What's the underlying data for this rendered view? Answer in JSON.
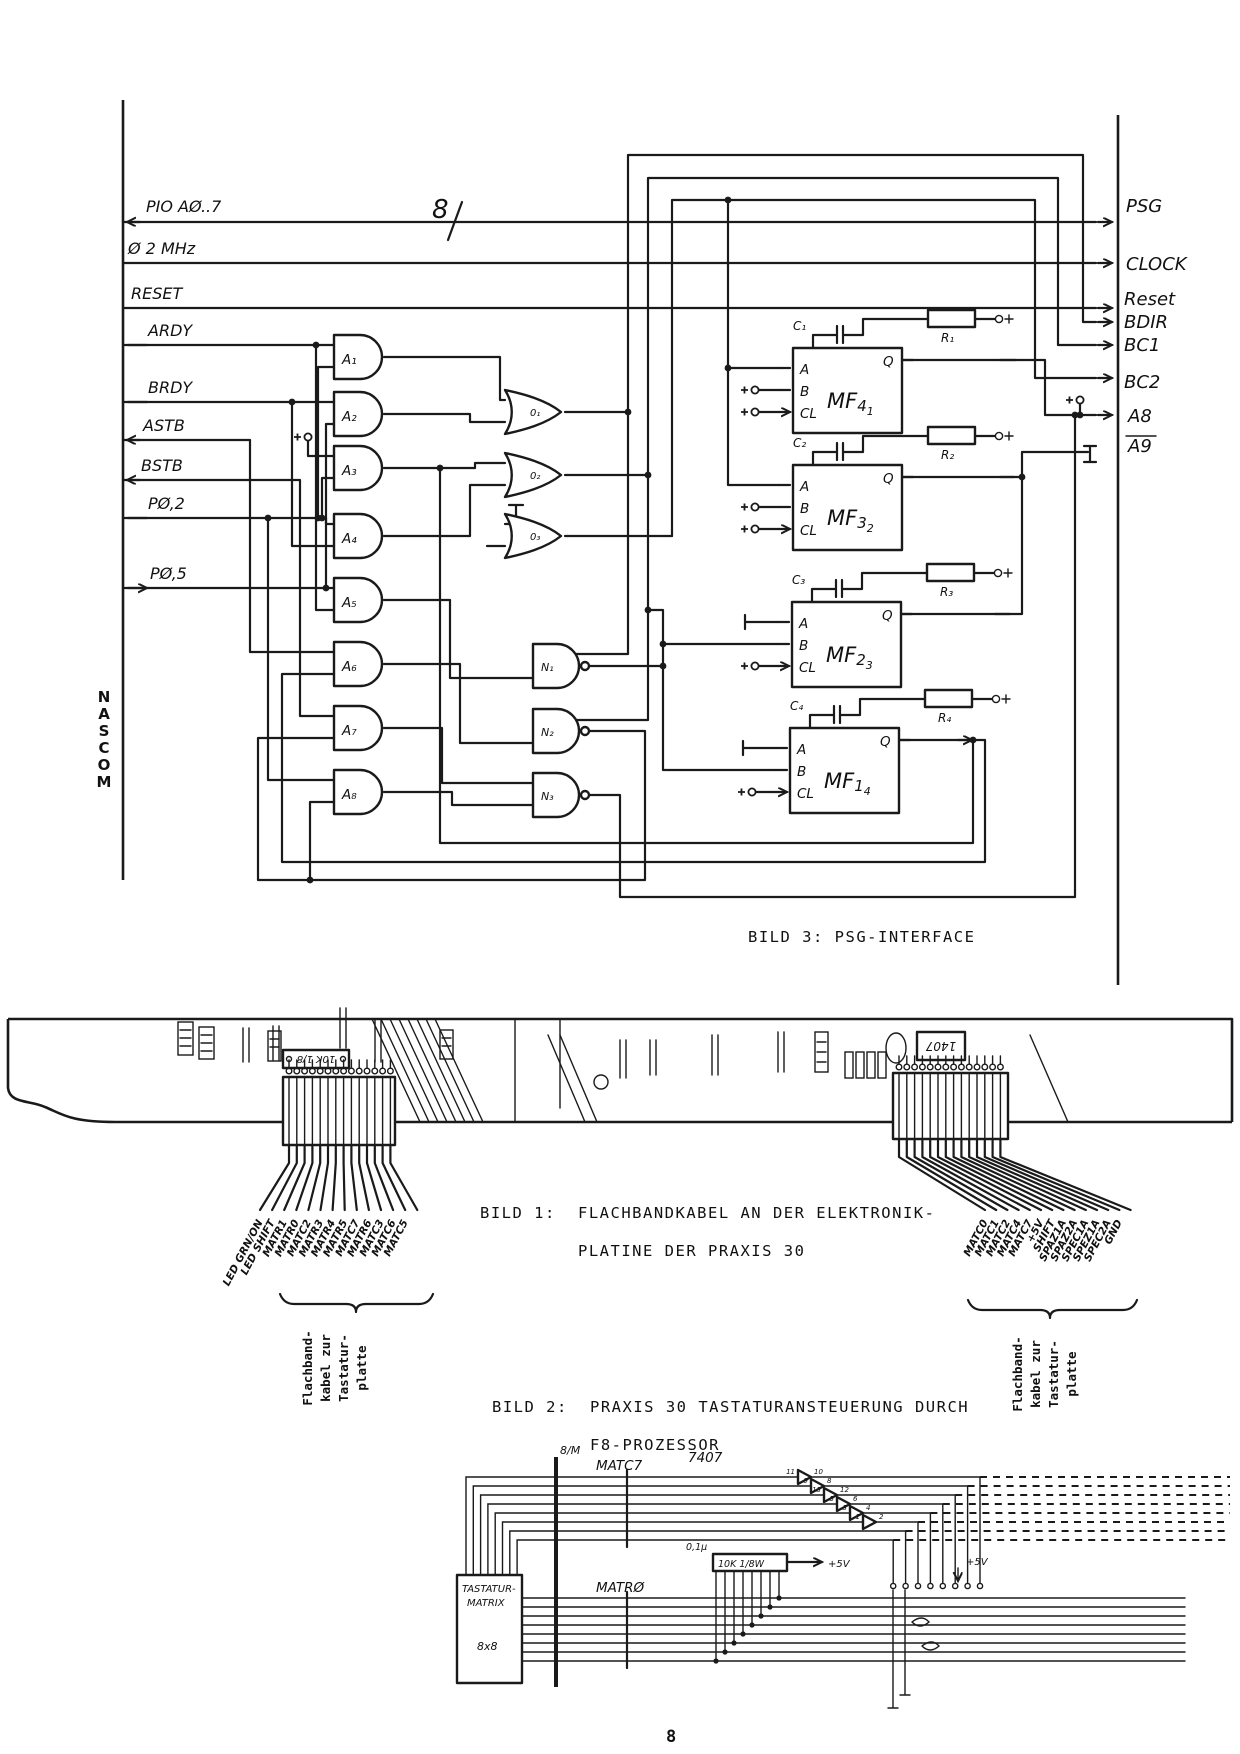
{
  "page": {
    "number": "8",
    "ink": "#1a1a1a",
    "background": "#ffffff"
  },
  "figure3": {
    "caption": "BILD 3:  PSG-INTERFACE",
    "side_label": "NASCOM",
    "bus_width_label": "8",
    "left_signals": [
      "PIO AØ..7",
      "Ø 2 MHz",
      "RESET",
      "ARDY",
      "BRDY",
      "ASTB",
      "BSTB",
      "PØ,2",
      "PØ,5"
    ],
    "right_signals": [
      "PSG",
      "CLOCK",
      "Reset",
      "BDIR",
      "BC1",
      "BC2",
      "A8",
      "A9"
    ],
    "overlined_right_signal": "A9",
    "and_gates": [
      "A₁",
      "A₂",
      "A₃",
      "A₄",
      "A₅",
      "A₆",
      "A₇",
      "A₈"
    ],
    "or_gates": [
      "0₁",
      "0₂",
      "0₃"
    ],
    "nand_gates": [
      "N₁",
      "N₂",
      "N₃"
    ],
    "mf_pins": {
      "a": "A",
      "b": "B",
      "cl": "CL",
      "q": "Q"
    },
    "mf_blocks": [
      {
        "label": "MF",
        "num": "4",
        "idx": "1",
        "cap": "C₁",
        "res": "R₁"
      },
      {
        "label": "MF",
        "num": "3",
        "idx": "2",
        "cap": "C₂",
        "res": "R₂"
      },
      {
        "label": "MF",
        "num": "2",
        "idx": "3",
        "cap": "C₃",
        "res": "R₃"
      },
      {
        "label": "MF",
        "num": "1",
        "idx": "4",
        "cap": "C₄",
        "res": "R₄"
      }
    ]
  },
  "figure1": {
    "caption_label": "BILD 1:",
    "caption_line1": "FLACHBANDKABEL AN DER ELEKTRONIK-",
    "caption_line2": "PLATINE DER PRAXIS 30",
    "ic_label": "1407",
    "resistor_label": "10K 1/8",
    "left_cable": {
      "labels": [
        "LED GRN/ON",
        "LED SHIFT",
        "MATR1",
        "MATR0",
        "MATC2",
        "MATR3",
        "MATR4",
        "MATR5",
        "MATC7",
        "MATR6",
        "MATC3",
        "MATC6",
        "MATC5"
      ]
    },
    "right_cable": {
      "labels": [
        "MATC0",
        "MATC1",
        "MATC2",
        "MATC4",
        "MATC7",
        "+5V",
        "SHIFT",
        "SPAZ1A",
        "SPAZ2A",
        "SPEC1A",
        "SPEZ1A",
        "SPEC2A",
        "GND"
      ]
    },
    "brace_note_lines": [
      "Flachband-",
      "kabel zur",
      "Tastatur-",
      "platte"
    ]
  },
  "figure2": {
    "caption_label": "BILD 2:",
    "caption_line1": "PRAXIS 30 TASTATURANSTEUERUNG DURCH",
    "caption_line2": "F8-PROZESSOR",
    "matrix_box": [
      "TASTATUR-",
      "MATRIX",
      "8x8"
    ],
    "bus_width_label": "8/M",
    "bus_label_top": "MATC7",
    "bus_label_bottom": "MATRØ",
    "ic_label": "7407",
    "resnet_label": "10K 1/8W",
    "cap_label": "0,1µ",
    "vcc_label": "+5V",
    "buffer_pins": [
      "11 10",
      "9 8",
      "13 12",
      "5 6",
      "3 4",
      "1 2"
    ]
  }
}
